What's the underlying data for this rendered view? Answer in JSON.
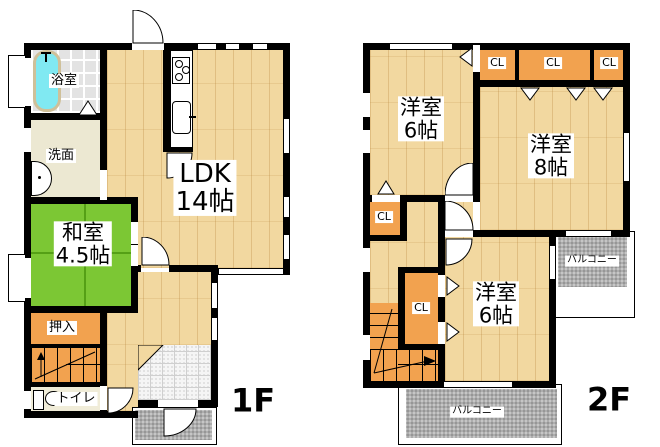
{
  "floor1": {
    "floor_label": "1F",
    "bath_label": "浴室",
    "washroom_label": "洗面",
    "ldk_label_line1": "LDK",
    "ldk_label_line2": "14帖",
    "washitsu_label_line1": "和室",
    "washitsu_label_line2": "4.5帖",
    "oshiire_label": "押入",
    "toilet_label": "トイレ"
  },
  "floor2": {
    "floor_label": "2F",
    "room_nw_label_line1": "洋室",
    "room_nw_label_line2": "6帖",
    "room_e_label_line1": "洋室",
    "room_e_label_line2": "8帖",
    "room_s_label_line1": "洋室",
    "room_s_label_line2": "6帖",
    "closet_label": "CL",
    "balcony_label": "バルコニー"
  },
  "colors": {
    "wall": "#000000",
    "wood_floor": "#f2d8a0",
    "tatami_green": "#7cc734",
    "closet_orange": "#f2a24f",
    "bathtub_cyan": "#80e9f2",
    "balcony_gray": "#adadad",
    "washroom_cream": "#ece8d2",
    "entrance_tile": "#f5f5f5"
  }
}
